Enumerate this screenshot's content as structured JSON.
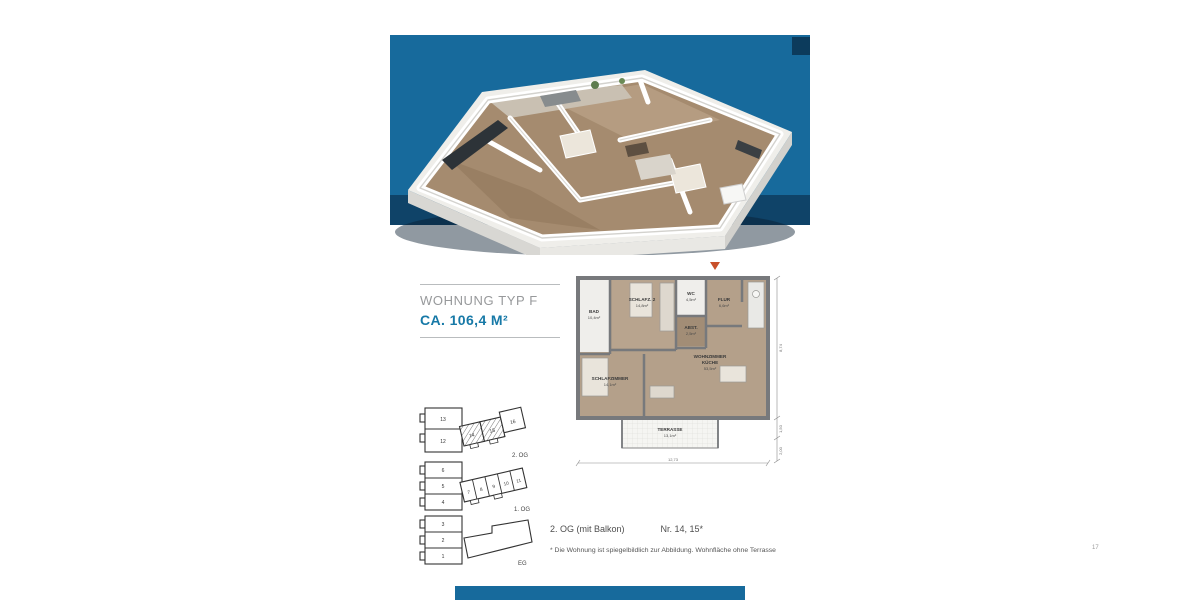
{
  "header": {
    "title": "WOHNUNG TYP F",
    "area": "CA. 106,4 M²"
  },
  "floorplan": {
    "rooms": [
      {
        "name": "BAD",
        "area": "10,4m²"
      },
      {
        "name": "SCHLAFZ. 2",
        "area": "14,8m²"
      },
      {
        "name": "WC",
        "area": "4,5m²"
      },
      {
        "name": "FLUR",
        "area": "6,6m²"
      },
      {
        "name": "ABST.",
        "area": "2,5m²"
      },
      {
        "name": "WOHNZIMMER",
        "name_line2": "KÜCHE",
        "area": "53,5m²"
      },
      {
        "name": "SCHLAFZIMMER",
        "area": "14,1m²"
      },
      {
        "name": "TERRASSE",
        "area": "13,1m²"
      }
    ],
    "dimensions": {
      "bottom_width": "12,73",
      "right_height": "8,74",
      "right_mid": "1,50",
      "right_bottom": "2,00"
    }
  },
  "levels": [
    {
      "label": "2. OG",
      "left_units": [
        "13",
        "12"
      ],
      "bar_units": [
        "14",
        "15",
        "16"
      ],
      "highlighted_units": "14, 15"
    },
    {
      "label": "1. OG",
      "left_units": [
        "6",
        "5",
        "4"
      ],
      "bar_units": [
        "7",
        "8",
        "9",
        "10",
        "11"
      ],
      "highlighted_units": ""
    },
    {
      "label": "EG",
      "left_units": [
        "3",
        "2",
        "1"
      ],
      "bar_units": [],
      "highlighted_units": ""
    }
  ],
  "footer": {
    "floor_info": "2. OG (mit Balkon)",
    "unit_info": "Nr. 14, 15*",
    "footnote": "* Die Wohnung ist spiegelbildlich zur Abbildung. Wohnfläche ohne Terrasse",
    "page_number": "17"
  },
  "colors": {
    "band_blue": "#176A9C",
    "band_shadow_navy": "#0E3C5F",
    "accent_blue": "#1779A7",
    "title_gray": "#97999B",
    "entrance_marker_orange": "#C8502A",
    "wall_gray": "#77797C",
    "wood_floor": "#B4A08A",
    "wood_floor_dark": "#A28D76",
    "tile_floor": "#EFEEEB"
  }
}
